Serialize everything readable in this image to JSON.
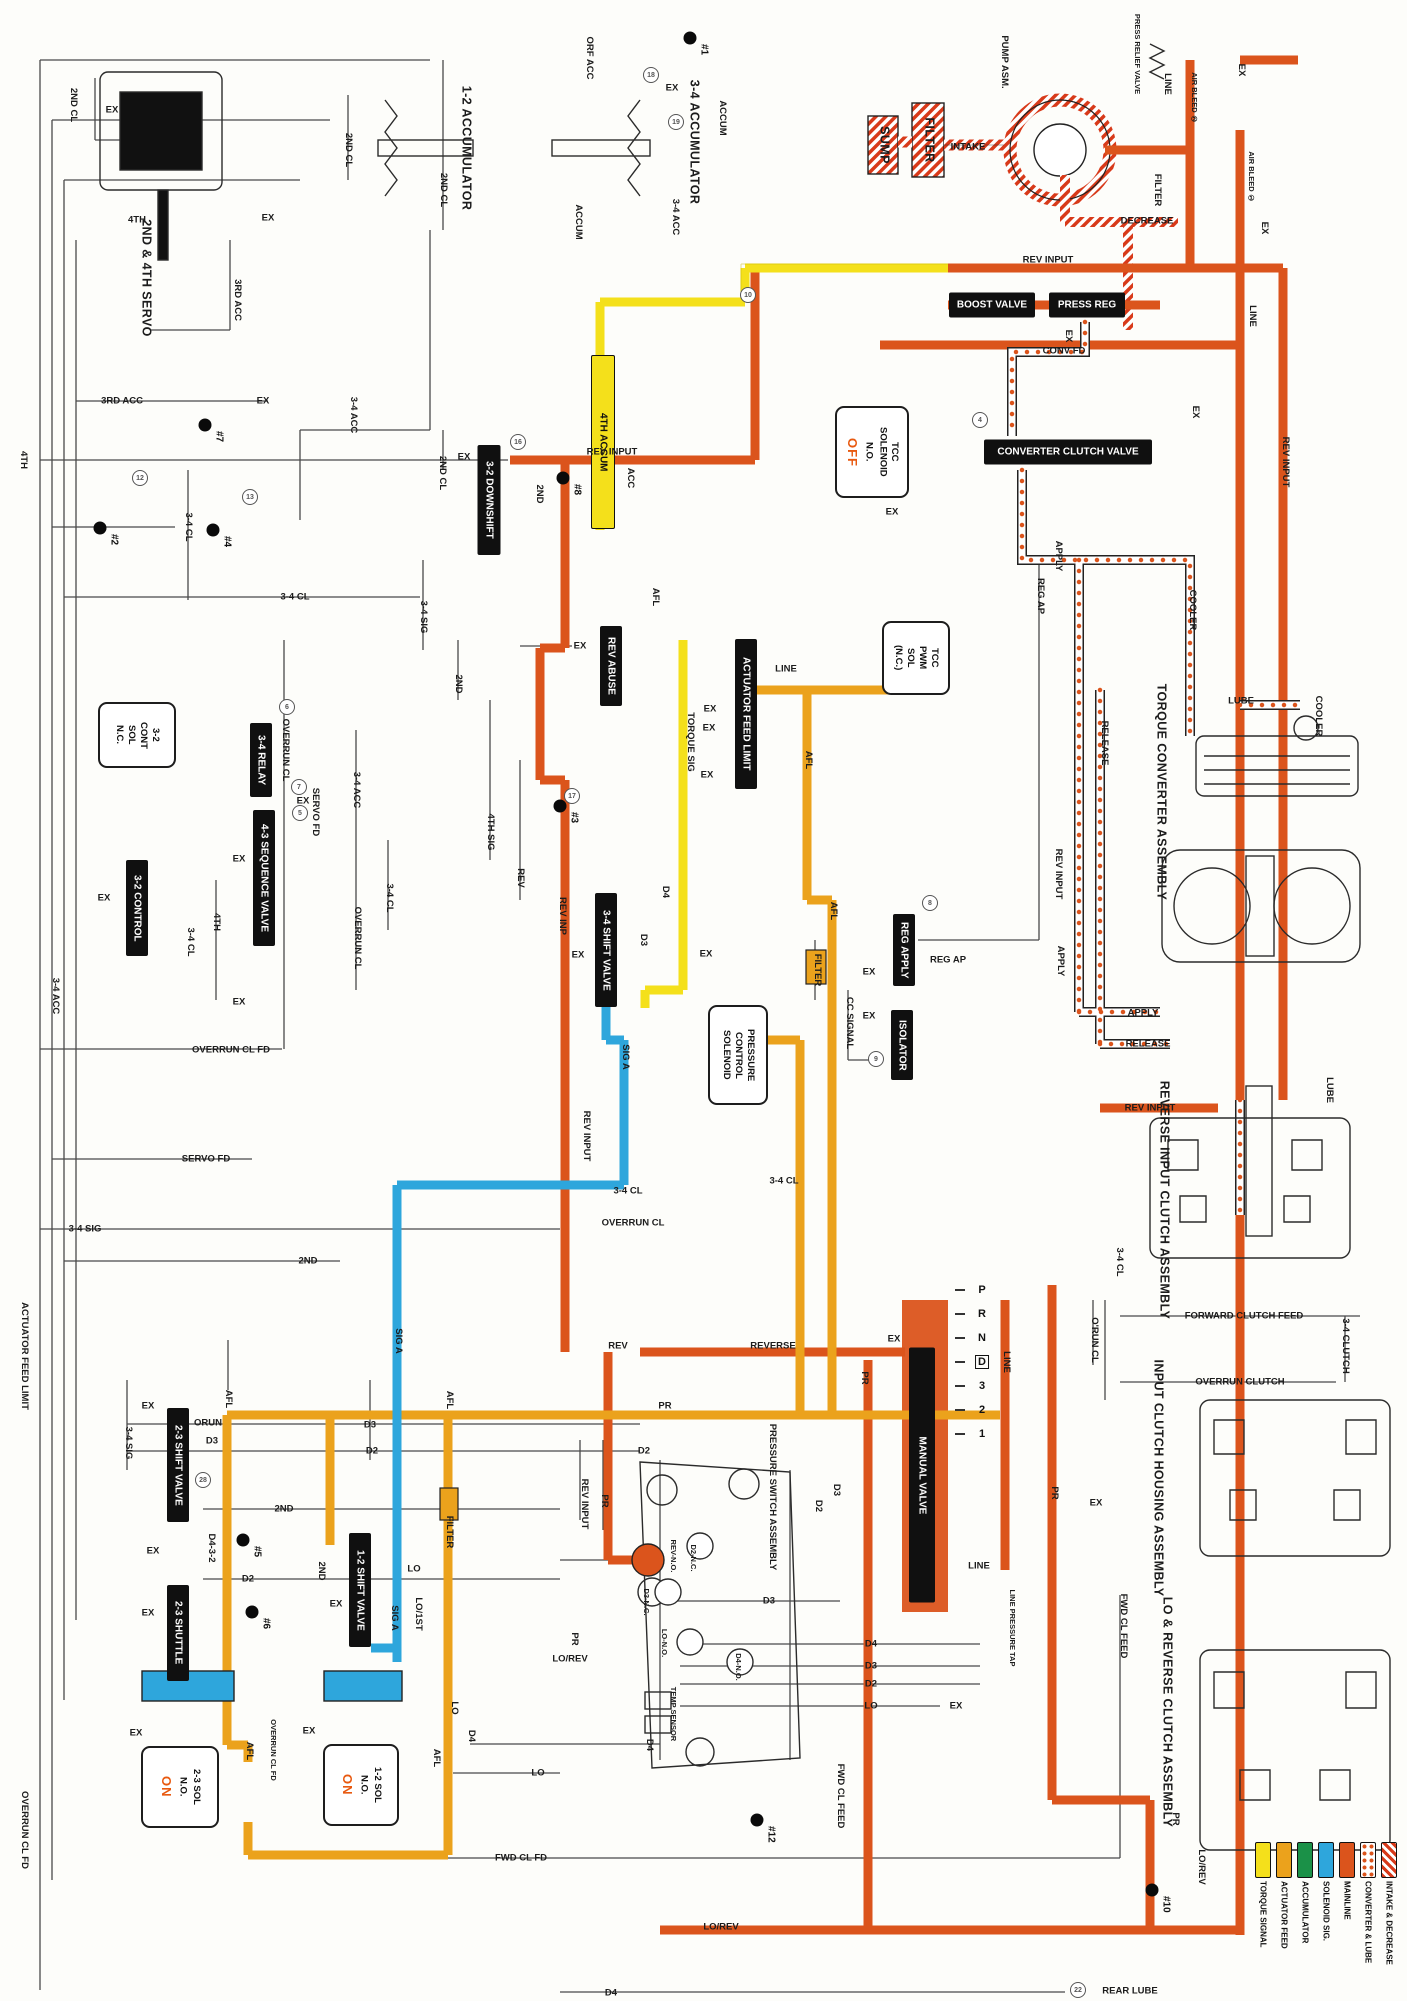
{
  "diagram_title": "Automatic transmission hydraulic circuit",
  "legend": {
    "items": [
      {
        "label": "TORQUE SIGNAL",
        "swatch": "solid",
        "color": "#F4E01B"
      },
      {
        "label": "ACTUATOR FEED",
        "swatch": "solid",
        "color": "#EBA21C"
      },
      {
        "label": "ACCUMULATOR",
        "swatch": "solid",
        "color": "#1B9148"
      },
      {
        "label": "SOLENOID SIG.",
        "swatch": "solid",
        "color": "#2EA6DC"
      },
      {
        "label": "MAINLINE",
        "swatch": "solid",
        "color": "#DB541C"
      },
      {
        "label": "CONVERTER & LUBE",
        "swatch": "dots",
        "color": "#DB541C"
      },
      {
        "label": "INTAKE & DECREASE",
        "swatch": "stripes",
        "color": "#D83A1A"
      }
    ]
  },
  "colors": {
    "mainline": "#DB541C",
    "torque_signal": "#F4E01B",
    "actuator_feed": "#EBA21C",
    "solenoid_sig": "#2EA6DC",
    "accumulator": "#1B9148",
    "intake": "#D83A1A",
    "state_accent": "#E8590F"
  },
  "valves": [
    {
      "t": "BOOST VALVE",
      "x": 992,
      "y": 305,
      "w": 86,
      "h": 25,
      "o": "h"
    },
    {
      "t": "PRESS REG",
      "x": 1087,
      "y": 305,
      "w": 76,
      "h": 25,
      "o": "h"
    },
    {
      "t": "CONVERTER CLUTCH VALVE",
      "x": 1068,
      "y": 452,
      "w": 168,
      "h": 25,
      "o": "h"
    },
    {
      "t": "3-2 DOWNSHIFT",
      "x": 489,
      "y": 500,
      "w": 23,
      "h": 110,
      "o": "v"
    },
    {
      "t": "4TH ACCUM",
      "x": 603,
      "y": 442,
      "w": 22,
      "h": 172,
      "o": "v",
      "c": "yellow"
    },
    {
      "t": "REV ABUSE",
      "x": 611,
      "y": 666,
      "w": 22,
      "h": 80,
      "o": "v"
    },
    {
      "t": "ACTUATOR FEED LIMIT",
      "x": 746,
      "y": 714,
      "w": 22,
      "h": 150,
      "o": "v"
    },
    {
      "t": "3-4 RELAY",
      "x": 261,
      "y": 760,
      "w": 22,
      "h": 74,
      "o": "v"
    },
    {
      "t": "4-3 SEQUENCE VALVE",
      "x": 264,
      "y": 878,
      "w": 22,
      "h": 136,
      "o": "v"
    },
    {
      "t": "3-2 CONTROL",
      "x": 137,
      "y": 908,
      "w": 22,
      "h": 96,
      "o": "v"
    },
    {
      "t": "3-4 SHIFT VALVE",
      "x": 606,
      "y": 950,
      "w": 22,
      "h": 114,
      "o": "v"
    },
    {
      "t": "REG APPLY",
      "x": 904,
      "y": 950,
      "w": 22,
      "h": 72,
      "o": "v"
    },
    {
      "t": "ISOLATOR",
      "x": 902,
      "y": 1045,
      "w": 22,
      "h": 70,
      "o": "v"
    },
    {
      "t": "MANUAL VALVE",
      "x": 922,
      "y": 1475,
      "w": 26,
      "h": 255,
      "o": "v"
    },
    {
      "t": "2-3 SHIFT VALVE",
      "x": 178,
      "y": 1465,
      "w": 22,
      "h": 114,
      "o": "v"
    },
    {
      "t": "2-3 SHUTTLE",
      "x": 178,
      "y": 1633,
      "w": 22,
      "h": 96,
      "o": "v"
    },
    {
      "t": "1-2 SHIFT VALVE",
      "x": 360,
      "y": 1590,
      "w": 22,
      "h": 114,
      "o": "v"
    }
  ],
  "solenoids": [
    {
      "lines": "3-2\nCONT\nSOL\nN.C.",
      "state": "",
      "x": 137,
      "y": 735,
      "w": 74,
      "h": 62
    },
    {
      "lines": "TCC\nSOLENOID\nN.O.",
      "state": "OFF",
      "x": 872,
      "y": 452,
      "w": 70,
      "h": 88
    },
    {
      "lines": "TCC\nPWM\nSOL\n(N.C.)",
      "state": "",
      "x": 916,
      "y": 658,
      "w": 64,
      "h": 70
    },
    {
      "lines": "PRESSURE\nCONTROL\nSOLENOID",
      "state": "",
      "x": 738,
      "y": 1055,
      "w": 56,
      "h": 96
    },
    {
      "lines": "2-3 SOL\nN.O.",
      "state": "ON",
      "x": 180,
      "y": 1787,
      "w": 74,
      "h": 78
    },
    {
      "lines": "1-2 SOL\nN.O.",
      "state": "ON",
      "x": 361,
      "y": 1785,
      "w": 72,
      "h": 78
    }
  ],
  "checkballs": [
    {
      "n": "#1",
      "x": 690,
      "y": 38
    },
    {
      "n": "#2",
      "x": 100,
      "y": 528
    },
    {
      "n": "#3",
      "x": 560,
      "y": 806
    },
    {
      "n": "#4",
      "x": 213,
      "y": 530
    },
    {
      "n": "#5",
      "x": 243,
      "y": 1540
    },
    {
      "n": "#6",
      "x": 252,
      "y": 1612
    },
    {
      "n": "#7",
      "x": 205,
      "y": 425
    },
    {
      "n": "#8",
      "x": 563,
      "y": 478
    },
    {
      "n": "#10",
      "x": 1152,
      "y": 1890
    },
    {
      "n": "#12",
      "x": 757,
      "y": 1820
    }
  ],
  "circled_refs": [
    {
      "n": "18",
      "x": 651,
      "y": 75
    },
    {
      "n": "19",
      "x": 676,
      "y": 122
    },
    {
      "n": "10",
      "x": 748,
      "y": 295
    },
    {
      "n": "4",
      "x": 980,
      "y": 420
    },
    {
      "n": "12",
      "x": 140,
      "y": 478
    },
    {
      "n": "13",
      "x": 250,
      "y": 497
    },
    {
      "n": "16",
      "x": 518,
      "y": 442
    },
    {
      "n": "6",
      "x": 287,
      "y": 707
    },
    {
      "n": "7",
      "x": 299,
      "y": 787
    },
    {
      "n": "5",
      "x": 300,
      "y": 813
    },
    {
      "n": "17",
      "x": 572,
      "y": 796
    },
    {
      "n": "8",
      "x": 930,
      "y": 903
    },
    {
      "n": "9",
      "x": 876,
      "y": 1059
    },
    {
      "n": "28",
      "x": 203,
      "y": 1480
    },
    {
      "n": "22",
      "x": 1078,
      "y": 1990
    }
  ],
  "gear_selector": {
    "positions": [
      "P",
      "R",
      "N",
      "D",
      "3",
      "2",
      "1"
    ],
    "boxed": "D",
    "x": 982,
    "y_start": 1290,
    "step": 24
  },
  "labels": [
    {
      "t": "2ND CL",
      "x": 73,
      "y": 105,
      "v": 1
    },
    {
      "t": "EX",
      "x": 112,
      "y": 110
    },
    {
      "t": "4TH",
      "x": 137,
      "y": 220
    },
    {
      "t": "3RD ACC",
      "x": 237,
      "y": 300,
      "v": 1
    },
    {
      "t": "EX",
      "x": 268,
      "y": 218
    },
    {
      "t": "2ND CL",
      "x": 348,
      "y": 150,
      "v": 1
    },
    {
      "t": "2ND CL",
      "x": 443,
      "y": 190,
      "v": 1
    },
    {
      "t": "ORF ACC",
      "x": 589,
      "y": 58,
      "v": 1
    },
    {
      "t": "EX",
      "x": 672,
      "y": 88
    },
    {
      "t": "ACCUM",
      "x": 722,
      "y": 118,
      "v": 1
    },
    {
      "t": "ACCUM",
      "x": 578,
      "y": 222,
      "v": 1
    },
    {
      "t": "3-4 ACC",
      "x": 675,
      "y": 217,
      "v": 1
    },
    {
      "t": "SUMP",
      "x": 884,
      "y": 145,
      "v": 1,
      "s": "lg"
    },
    {
      "t": "FILTER",
      "x": 929,
      "y": 140,
      "v": 1,
      "s": "lg"
    },
    {
      "t": "INTAKE",
      "x": 968,
      "y": 147
    },
    {
      "t": "PUMP ASM.",
      "x": 1004,
      "y": 62,
      "v": 1
    },
    {
      "t": "PRESS RELIEF VALVE",
      "x": 1137,
      "y": 54,
      "v": 1,
      "s": "xs"
    },
    {
      "t": "LINE",
      "x": 1167,
      "y": 84,
      "v": 1
    },
    {
      "t": "AIR BLEED ②",
      "x": 1194,
      "y": 98,
      "v": 1,
      "s": "xs"
    },
    {
      "t": "EX",
      "x": 1241,
      "y": 70,
      "v": 1
    },
    {
      "t": "FILTER",
      "x": 1157,
      "y": 190,
      "v": 1
    },
    {
      "t": "AIR BLEED ①",
      "x": 1251,
      "y": 177,
      "v": 1,
      "s": "xs"
    },
    {
      "t": "DECREASE",
      "x": 1147,
      "y": 221
    },
    {
      "t": "EX",
      "x": 1264,
      "y": 228,
      "v": 1
    },
    {
      "t": "REV INPUT",
      "x": 1048,
      "y": 260
    },
    {
      "t": "EX",
      "x": 1068,
      "y": 336,
      "v": 1
    },
    {
      "t": "CONV FD",
      "x": 1064,
      "y": 351
    },
    {
      "t": "LINE",
      "x": 1252,
      "y": 316,
      "v": 1
    },
    {
      "t": "REV INPUT",
      "x": 1285,
      "y": 462,
      "v": 1
    },
    {
      "t": "EX",
      "x": 1195,
      "y": 412,
      "v": 1
    },
    {
      "t": "EX",
      "x": 892,
      "y": 512
    },
    {
      "t": "APPLY",
      "x": 1058,
      "y": 556,
      "v": 1
    },
    {
      "t": "REG AP",
      "x": 1040,
      "y": 596,
      "v": 1
    },
    {
      "t": "COOLER",
      "x": 1192,
      "y": 610,
      "v": 1
    },
    {
      "t": "REV INPUT",
      "x": 612,
      "y": 452
    },
    {
      "t": "3-4 CL",
      "x": 295,
      "y": 597
    },
    {
      "t": "3-4 CL",
      "x": 188,
      "y": 527,
      "v": 1
    },
    {
      "t": "2ND CL",
      "x": 442,
      "y": 473,
      "v": 1
    },
    {
      "t": "EX",
      "x": 464,
      "y": 457
    },
    {
      "t": "2ND",
      "x": 539,
      "y": 494,
      "v": 1
    },
    {
      "t": "3-4 SIG",
      "x": 423,
      "y": 617,
      "v": 1
    },
    {
      "t": "2ND",
      "x": 458,
      "y": 684,
      "v": 1
    },
    {
      "t": "EX",
      "x": 580,
      "y": 646
    },
    {
      "t": "ACC",
      "x": 630,
      "y": 478,
      "v": 1
    },
    {
      "t": "TORQUE SIG",
      "x": 690,
      "y": 742,
      "v": 1
    },
    {
      "t": "LINE",
      "x": 786,
      "y": 669
    },
    {
      "t": "EX",
      "x": 710,
      "y": 709
    },
    {
      "t": "EX",
      "x": 709,
      "y": 728
    },
    {
      "t": "EX",
      "x": 707,
      "y": 775
    },
    {
      "t": "AFL",
      "x": 808,
      "y": 760,
      "v": 1
    },
    {
      "t": "AFL",
      "x": 655,
      "y": 597,
      "v": 1
    },
    {
      "t": "D4",
      "x": 665,
      "y": 892,
      "v": 1
    },
    {
      "t": "AFL",
      "x": 833,
      "y": 911,
      "v": 1
    },
    {
      "t": "4TH SIG",
      "x": 490,
      "y": 832,
      "v": 1
    },
    {
      "t": "REV",
      "x": 520,
      "y": 878,
      "v": 1
    },
    {
      "t": "REV INP",
      "x": 562,
      "y": 916,
      "v": 1
    },
    {
      "t": "D3",
      "x": 643,
      "y": 940,
      "v": 1
    },
    {
      "t": "EX",
      "x": 578,
      "y": 955
    },
    {
      "t": "SIG A",
      "x": 625,
      "y": 1057,
      "v": 1
    },
    {
      "t": "REV INPUT",
      "x": 586,
      "y": 1136,
      "v": 1
    },
    {
      "t": "EX",
      "x": 706,
      "y": 954
    },
    {
      "t": "FILTER",
      "x": 817,
      "y": 970,
      "v": 1
    },
    {
      "t": "CC SIGNAL",
      "x": 849,
      "y": 1023,
      "v": 1
    },
    {
      "t": "REG AP",
      "x": 948,
      "y": 960
    },
    {
      "t": "EX",
      "x": 869,
      "y": 972
    },
    {
      "t": "EX",
      "x": 869,
      "y": 1016
    },
    {
      "t": "3-4 CL",
      "x": 784,
      "y": 1181
    },
    {
      "t": "3-4 CL",
      "x": 628,
      "y": 1191
    },
    {
      "t": "OVERRUN CL",
      "x": 633,
      "y": 1223
    },
    {
      "t": "LUBE",
      "x": 1241,
      "y": 701
    },
    {
      "t": "COOLER",
      "x": 1318,
      "y": 716,
      "v": 1
    },
    {
      "t": "RELEASE",
      "x": 1104,
      "y": 743,
      "v": 1
    },
    {
      "t": "REV INPUT",
      "x": 1058,
      "y": 874,
      "v": 1
    },
    {
      "t": "APPLY",
      "x": 1060,
      "y": 961,
      "v": 1
    },
    {
      "t": "APPLY",
      "x": 1143,
      "y": 1013
    },
    {
      "t": "RELEASE",
      "x": 1148,
      "y": 1044
    },
    {
      "t": "REV INPUT",
      "x": 1150,
      "y": 1108
    },
    {
      "t": "LUBE",
      "x": 1329,
      "y": 1090,
      "v": 1
    },
    {
      "t": "3-4 CL",
      "x": 1119,
      "y": 1262,
      "v": 1
    },
    {
      "t": "FORWARD CLUTCH FEED",
      "x": 1244,
      "y": 1316
    },
    {
      "t": "OVERRUN CLUTCH",
      "x": 1240,
      "y": 1382
    },
    {
      "t": "3-4 CLUTCH",
      "x": 1345,
      "y": 1346,
      "v": 1
    },
    {
      "t": "O'RUN CL",
      "x": 1094,
      "y": 1340,
      "v": 1
    },
    {
      "t": "EX",
      "x": 1096,
      "y": 1503
    },
    {
      "t": "FWD CL FEED",
      "x": 1123,
      "y": 1626,
      "v": 1
    },
    {
      "t": "PR",
      "x": 1175,
      "y": 1819,
      "v": 1
    },
    {
      "t": "LO/REV",
      "x": 1201,
      "y": 1867,
      "v": 1
    },
    {
      "t": "REAR LUBE",
      "x": 1130,
      "y": 1991
    },
    {
      "t": "EX",
      "x": 894,
      "y": 1339
    },
    {
      "t": "PR",
      "x": 864,
      "y": 1378,
      "v": 1
    },
    {
      "t": "LINE",
      "x": 1006,
      "y": 1362,
      "v": 1
    },
    {
      "t": "PR",
      "x": 1054,
      "y": 1493,
      "v": 1
    },
    {
      "t": "LINE",
      "x": 979,
      "y": 1566
    },
    {
      "t": "LINE PRESSURE TAP",
      "x": 1012,
      "y": 1628,
      "v": 1,
      "s": "xs"
    },
    {
      "t": "D2",
      "x": 644,
      "y": 1451
    },
    {
      "t": "PR",
      "x": 604,
      "y": 1501,
      "v": 1
    },
    {
      "t": "REV INPUT",
      "x": 584,
      "y": 1504,
      "v": 1
    },
    {
      "t": "D3",
      "x": 836,
      "y": 1490,
      "v": 1
    },
    {
      "t": "D2",
      "x": 818,
      "y": 1506,
      "v": 1
    },
    {
      "t": "REV-N.O.",
      "x": 673,
      "y": 1556,
      "v": 1,
      "s": "xs"
    },
    {
      "t": "D2-N.C.",
      "x": 693,
      "y": 1558,
      "v": 1,
      "s": "xs"
    },
    {
      "t": "D3-N.C.",
      "x": 646,
      "y": 1602,
      "v": 1,
      "s": "xs"
    },
    {
      "t": "LO-N.O.",
      "x": 664,
      "y": 1643,
      "v": 1,
      "s": "xs"
    },
    {
      "t": "D4-N.O.",
      "x": 738,
      "y": 1667,
      "v": 1,
      "s": "xs"
    },
    {
      "t": "D3",
      "x": 769,
      "y": 1601
    },
    {
      "t": "D4",
      "x": 871,
      "y": 1644
    },
    {
      "t": "D3",
      "x": 871,
      "y": 1666
    },
    {
      "t": "D2",
      "x": 871,
      "y": 1684
    },
    {
      "t": "LO",
      "x": 871,
      "y": 1706
    },
    {
      "t": "EX",
      "x": 956,
      "y": 1706
    },
    {
      "t": "PR",
      "x": 574,
      "y": 1639,
      "v": 1
    },
    {
      "t": "LO/REV",
      "x": 570,
      "y": 1659
    },
    {
      "t": "D4",
      "x": 649,
      "y": 1745,
      "v": 1
    },
    {
      "t": "LO",
      "x": 538,
      "y": 1773
    },
    {
      "t": "3-4 SIG",
      "x": 128,
      "y": 1443,
      "v": 1
    },
    {
      "t": "EX",
      "x": 148,
      "y": 1406
    },
    {
      "t": "ORUN",
      "x": 208,
      "y": 1423
    },
    {
      "t": "D3",
      "x": 212,
      "y": 1441
    },
    {
      "t": "AFL",
      "x": 228,
      "y": 1399,
      "v": 1
    },
    {
      "t": "D3",
      "x": 370,
      "y": 1425
    },
    {
      "t": "D2",
      "x": 372,
      "y": 1451
    },
    {
      "t": "SIG A",
      "x": 398,
      "y": 1341,
      "v": 1
    },
    {
      "t": "AFL",
      "x": 449,
      "y": 1400,
      "v": 1
    },
    {
      "t": "2ND",
      "x": 284,
      "y": 1509
    },
    {
      "t": "D4-3-2",
      "x": 211,
      "y": 1548,
      "v": 1
    },
    {
      "t": "D2",
      "x": 248,
      "y": 1579
    },
    {
      "t": "2ND",
      "x": 321,
      "y": 1571,
      "v": 1
    },
    {
      "t": "EX",
      "x": 153,
      "y": 1551
    },
    {
      "t": "EX",
      "x": 148,
      "y": 1613
    },
    {
      "t": "EX",
      "x": 336,
      "y": 1604
    },
    {
      "t": "FILTER",
      "x": 449,
      "y": 1532,
      "v": 1
    },
    {
      "t": "LO",
      "x": 414,
      "y": 1569
    },
    {
      "t": "LO/1ST",
      "x": 418,
      "y": 1614,
      "v": 1
    },
    {
      "t": "SIG A",
      "x": 394,
      "y": 1618,
      "v": 1
    },
    {
      "t": "EX",
      "x": 136,
      "y": 1733
    },
    {
      "t": "AFL",
      "x": 249,
      "y": 1751,
      "v": 1
    },
    {
      "t": "OVERRUN CL FD",
      "x": 273,
      "y": 1750,
      "v": 1,
      "s": "xs"
    },
    {
      "t": "EX",
      "x": 309,
      "y": 1731
    },
    {
      "t": "AFL",
      "x": 436,
      "y": 1758,
      "v": 1
    },
    {
      "t": "LO",
      "x": 454,
      "y": 1708,
      "v": 1
    },
    {
      "t": "D4",
      "x": 471,
      "y": 1736,
      "v": 1
    },
    {
      "t": "FWD CL FD",
      "x": 521,
      "y": 1858
    },
    {
      "t": "FWD CL FEED",
      "x": 840,
      "y": 1796,
      "v": 1
    },
    {
      "t": "LO/REV",
      "x": 721,
      "y": 1927
    },
    {
      "t": "D4",
      "x": 611,
      "y": 1993
    },
    {
      "t": "OVERRUN CL FD",
      "x": 231,
      "y": 1050
    },
    {
      "t": "SERVO FD",
      "x": 206,
      "y": 1159
    },
    {
      "t": "3-4 SIG",
      "x": 85,
      "y": 1229
    },
    {
      "t": "3-4 ACC",
      "x": 55,
      "y": 996,
      "v": 1
    },
    {
      "t": "2ND",
      "x": 308,
      "y": 1261
    },
    {
      "t": "ACTUATOR FEED LIMIT",
      "x": 24,
      "y": 1356,
      "v": 1
    },
    {
      "t": "4TH",
      "x": 23,
      "y": 460,
      "v": 1
    },
    {
      "t": "OVERRUN CL FD",
      "x": 24,
      "y": 1830,
      "v": 1
    },
    {
      "t": "3RD ACC",
      "x": 122,
      "y": 401
    },
    {
      "t": "EX",
      "x": 263,
      "y": 401
    },
    {
      "t": "3-4 ACC",
      "x": 353,
      "y": 415,
      "v": 1
    },
    {
      "t": "EX",
      "x": 104,
      "y": 898
    },
    {
      "t": "EX",
      "x": 239,
      "y": 859
    },
    {
      "t": "SERVO FD",
      "x": 315,
      "y": 812,
      "v": 1
    },
    {
      "t": "EX",
      "x": 303,
      "y": 801
    },
    {
      "t": "3-4 ACC",
      "x": 356,
      "y": 790,
      "v": 1
    },
    {
      "t": "OVERRUN CL",
      "x": 357,
      "y": 938,
      "v": 1
    },
    {
      "t": "3-4 CL",
      "x": 389,
      "y": 898,
      "v": 1
    },
    {
      "t": "4TH",
      "x": 216,
      "y": 922,
      "v": 1
    },
    {
      "t": "EX",
      "x": 239,
      "y": 1002
    },
    {
      "t": "3-4 CL",
      "x": 190,
      "y": 942,
      "v": 1
    },
    {
      "t": "OVERRUN CL",
      "x": 285,
      "y": 750,
      "v": 1
    },
    {
      "t": "REV",
      "x": 618,
      "y": 1346
    },
    {
      "t": "REVERSE",
      "x": 773,
      "y": 1346
    },
    {
      "t": "PR",
      "x": 665,
      "y": 1406
    },
    {
      "t": "2ND & 4TH SERVO",
      "x": 146,
      "y": 278,
      "v": 1,
      "s": "lg"
    },
    {
      "t": "1-2 ACCUMULATOR",
      "x": 466,
      "y": 148,
      "v": 1,
      "s": "lg"
    },
    {
      "t": "3-4 ACCUMULATOR",
      "x": 694,
      "y": 142,
      "v": 1,
      "s": "lg"
    },
    {
      "t": "TORQUE CONVERTER ASSEMBLY",
      "x": 1161,
      "y": 792,
      "v": 1,
      "s": "lg"
    },
    {
      "t": "REVERSE INPUT CLUTCH ASSEMBLY",
      "x": 1164,
      "y": 1200,
      "v": 1,
      "s": "lg"
    },
    {
      "t": "INPUT CLUTCH HOUSING ASSEMBLY",
      "x": 1158,
      "y": 1478,
      "v": 1,
      "s": "lg"
    },
    {
      "t": "LO & REVERSE CLUTCH ASSEMBLY",
      "x": 1167,
      "y": 1712,
      "v": 1,
      "s": "lg"
    },
    {
      "t": "PRESSURE SWITCH ASSEMBLY",
      "x": 772,
      "y": 1497,
      "v": 1
    },
    {
      "t": "TEMP SENSOR",
      "x": 673,
      "y": 1714,
      "v": 1,
      "s": "xs"
    }
  ]
}
